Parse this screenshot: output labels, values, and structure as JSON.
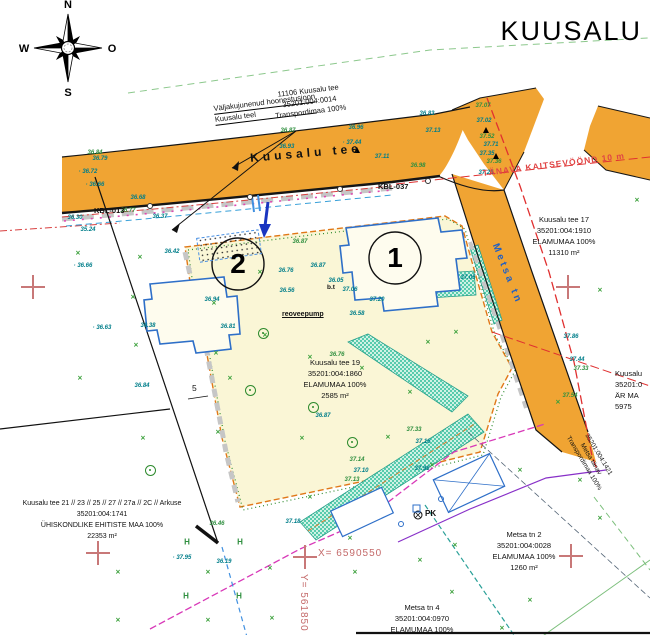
{
  "title": "KUUSALU",
  "compass": {
    "n": "N",
    "w": "W",
    "e": "O",
    "s": "S"
  },
  "annotation": {
    "line1": "Väljakujunenud hoonestusjoon",
    "line2": "Kuusalu teel"
  },
  "road_labels": {
    "kuusalu_tee": "Kuusalu tee",
    "metsa_tn": "Metsa tn",
    "kbl_013": "KBL-013",
    "kbl_037": "KBL-037",
    "tanava_kaitsevoond": "TÄNAVA KAITSEVÖÖND 10 m"
  },
  "coords": {
    "x_label": "X=  6590550",
    "y_label": "Y=  561850"
  },
  "plot_numbers": {
    "plot1": "1",
    "plot2": "2"
  },
  "misc": {
    "pk": "PK",
    "bt": "b.t",
    "pump": "reoveepump",
    "dim5": "5"
  },
  "parcels": [
    {
      "name": "road-parcel",
      "lines": [
        "11106 Kuusalu tee",
        "35201:004:0014",
        "Transpordimaa 100%"
      ]
    },
    {
      "name": "kuusalu-tee-17",
      "lines": [
        "Kuusalu tee 17",
        "35201:004:1910",
        "ELAMUMAA 100%",
        "11310 m²"
      ]
    },
    {
      "name": "kuusalu-tee-19",
      "lines": [
        "Kuusalu tee 19",
        "35201:004:1860",
        "ELAMUMAA 100%",
        "2585 m²"
      ]
    },
    {
      "name": "kuusalu-tee-21",
      "lines": [
        "Kuusalu tee 21 // 23 // 25 // 27 // 27a // 2C // Arkuse",
        "35201:004:1741",
        "ÜHISKONDLIKE EHITISTE MAA 100%",
        "22353 m²"
      ]
    },
    {
      "name": "metsa-tn-2",
      "lines": [
        "Metsa tn 2",
        "35201:004:0028",
        "ELAMUMAA 100%",
        "1260 m²"
      ]
    },
    {
      "name": "metsa-tn-4",
      "lines": [
        "Metsa tn 4",
        "35201:004:0970",
        "ELAMUMAA 100%"
      ]
    },
    {
      "name": "arimaa-clipped",
      "lines": [
        "Kuusalu",
        "35201:0",
        "ÄR MA",
        "5975"
      ]
    },
    {
      "name": "metsa-tanav-road",
      "lines": [
        "35201:004:1421",
        "Metsa tänav",
        "Transpordimaa 100%"
      ]
    }
  ],
  "spot_heights": [
    {
      "x": 100,
      "y": 159,
      "v": "36.79",
      "c": "t"
    },
    {
      "x": 95,
      "y": 153,
      "v": "36.84",
      "c": "g"
    },
    {
      "x": 88,
      "y": 172,
      "v": "· 36.72",
      "c": "t"
    },
    {
      "x": 95,
      "y": 185,
      "v": "· 36.66",
      "c": "t"
    },
    {
      "x": 138,
      "y": 198,
      "v": "36.68",
      "c": "t"
    },
    {
      "x": 128,
      "y": 211,
      "v": "36.77",
      "c": "g"
    },
    {
      "x": 75,
      "y": 218,
      "v": "36.30",
      "c": "t"
    },
    {
      "x": 160,
      "y": 217,
      "v": "36.37",
      "c": "t"
    },
    {
      "x": 88,
      "y": 230,
      "v": "35.24",
      "c": "t"
    },
    {
      "x": 288,
      "y": 131,
      "v": "36.87",
      "c": "g"
    },
    {
      "x": 285,
      "y": 147,
      "v": "· 36.93",
      "c": "t"
    },
    {
      "x": 356,
      "y": 128,
      "v": "36.96",
      "c": "t"
    },
    {
      "x": 352,
      "y": 143,
      "v": "· 37.44",
      "c": "t"
    },
    {
      "x": 382,
      "y": 157,
      "v": "37.11",
      "c": "t"
    },
    {
      "x": 418,
      "y": 166,
      "v": "36.98",
      "c": "g"
    },
    {
      "x": 300,
      "y": 242,
      "v": "36.87",
      "c": "g"
    },
    {
      "x": 318,
      "y": 266,
      "v": "36.87",
      "c": "t"
    },
    {
      "x": 286,
      "y": 271,
      "v": "36.76",
      "c": "t"
    },
    {
      "x": 287,
      "y": 291,
      "v": "36.56",
      "c": "t"
    },
    {
      "x": 357,
      "y": 314,
      "v": "36.58",
      "c": "t"
    },
    {
      "x": 336,
      "y": 281,
      "v": "36.05",
      "c": "t"
    },
    {
      "x": 350,
      "y": 290,
      "v": "37.06",
      "c": "t"
    },
    {
      "x": 377,
      "y": 300,
      "v": "37.20",
      "c": "t"
    },
    {
      "x": 212,
      "y": 300,
      "v": "36.94",
      "c": "t"
    },
    {
      "x": 228,
      "y": 327,
      "v": "36.81",
      "c": "t"
    },
    {
      "x": 83,
      "y": 266,
      "v": "· 36.66",
      "c": "t"
    },
    {
      "x": 102,
      "y": 328,
      "v": "· 36.63",
      "c": "t"
    },
    {
      "x": 172,
      "y": 252,
      "v": "36.42",
      "c": "t"
    },
    {
      "x": 148,
      "y": 326,
      "v": "36.38",
      "c": "t"
    },
    {
      "x": 142,
      "y": 386,
      "v": "36.84",
      "c": "t"
    },
    {
      "x": 182,
      "y": 558,
      "v": "· 37.95",
      "c": "t"
    },
    {
      "x": 224,
      "y": 562,
      "v": "36.19",
      "c": "t"
    },
    {
      "x": 217,
      "y": 524,
      "v": "36.46",
      "c": "g"
    },
    {
      "x": 293,
      "y": 522,
      "v": "37.18",
      "c": "t"
    },
    {
      "x": 427,
      "y": 114,
      "v": "36.83",
      "c": "t"
    },
    {
      "x": 483,
      "y": 106,
      "v": "37.07",
      "c": "g"
    },
    {
      "x": 484,
      "y": 121,
      "v": "37.02",
      "c": "t"
    },
    {
      "x": 433,
      "y": 131,
      "v": "37.13",
      "c": "t"
    },
    {
      "x": 487,
      "y": 137,
      "v": "37.52",
      "c": "g"
    },
    {
      "x": 491,
      "y": 145,
      "v": "37.71",
      "c": "t"
    },
    {
      "x": 487,
      "y": 154,
      "v": "37.35",
      "c": "t"
    },
    {
      "x": 494,
      "y": 162,
      "v": "37.36",
      "c": "g"
    },
    {
      "x": 486,
      "y": 173,
      "v": "37.24",
      "c": "t"
    },
    {
      "x": 468,
      "y": 278,
      "v": "37.05",
      "c": "t"
    },
    {
      "x": 571,
      "y": 337,
      "v": "37.86",
      "c": "t"
    },
    {
      "x": 577,
      "y": 360,
      "v": "37.44",
      "c": "t"
    },
    {
      "x": 581,
      "y": 369,
      "v": "37.33",
      "c": "g"
    },
    {
      "x": 570,
      "y": 396,
      "v": "37.54",
      "c": "g"
    },
    {
      "x": 414,
      "y": 430,
      "v": "37.33",
      "c": "g"
    },
    {
      "x": 423,
      "y": 442,
      "v": "37.16",
      "c": "t"
    },
    {
      "x": 357,
      "y": 460,
      "v": "37.14",
      "c": "g"
    },
    {
      "x": 361,
      "y": 471,
      "v": "37.10",
      "c": "t"
    },
    {
      "x": 422,
      "y": 469,
      "v": "37.98",
      "c": "t"
    },
    {
      "x": 352,
      "y": 480,
      "v": "37.13",
      "c": "g"
    },
    {
      "x": 323,
      "y": 416,
      "v": "36.87",
      "c": "t"
    },
    {
      "x": 337,
      "y": 355,
      "v": "36.76",
      "c": "g"
    }
  ],
  "grass_marks": [
    [
      78,
      253
    ],
    [
      140,
      257
    ],
    [
      133,
      297
    ],
    [
      214,
      303
    ],
    [
      136,
      345
    ],
    [
      216,
      353
    ],
    [
      80,
      378
    ],
    [
      143,
      438
    ],
    [
      218,
      432
    ],
    [
      260,
      272
    ],
    [
      310,
      357
    ],
    [
      362,
      368
    ],
    [
      428,
      342
    ],
    [
      456,
      332
    ],
    [
      302,
      438
    ],
    [
      388,
      437
    ],
    [
      265,
      335
    ],
    [
      230,
      378
    ],
    [
      410,
      392
    ],
    [
      118,
      572
    ],
    [
      208,
      572
    ],
    [
      270,
      568
    ],
    [
      118,
      620
    ],
    [
      208,
      620
    ],
    [
      272,
      618
    ],
    [
      355,
      572
    ],
    [
      420,
      560
    ],
    [
      455,
      545
    ],
    [
      530,
      600
    ],
    [
      600,
      518
    ],
    [
      580,
      480
    ],
    [
      520,
      470
    ],
    [
      350,
      538
    ],
    [
      558,
      402
    ],
    [
      637,
      200
    ],
    [
      600,
      290
    ],
    [
      452,
      592
    ],
    [
      502,
      628
    ],
    [
      310,
      497
    ],
    [
      432,
      465
    ]
  ],
  "h_marks": [
    [
      187,
      542
    ],
    [
      240,
      542
    ],
    [
      186,
      596
    ],
    [
      239,
      596
    ]
  ],
  "trees": [
    [
      313,
      407
    ],
    [
      263,
      333
    ],
    [
      150,
      470
    ],
    [
      352,
      442
    ],
    [
      250,
      390
    ]
  ],
  "crosses": [
    [
      33,
      287
    ],
    [
      568,
      287
    ],
    [
      98,
      553
    ],
    [
      305,
      557
    ],
    [
      571,
      556
    ]
  ],
  "poles": [
    [
      150,
      206
    ],
    [
      250,
      197
    ],
    [
      340,
      189
    ],
    [
      428,
      181
    ]
  ],
  "triangles": [
    [
      358,
      152
    ],
    [
      487,
      132
    ],
    [
      497,
      158
    ]
  ]
}
